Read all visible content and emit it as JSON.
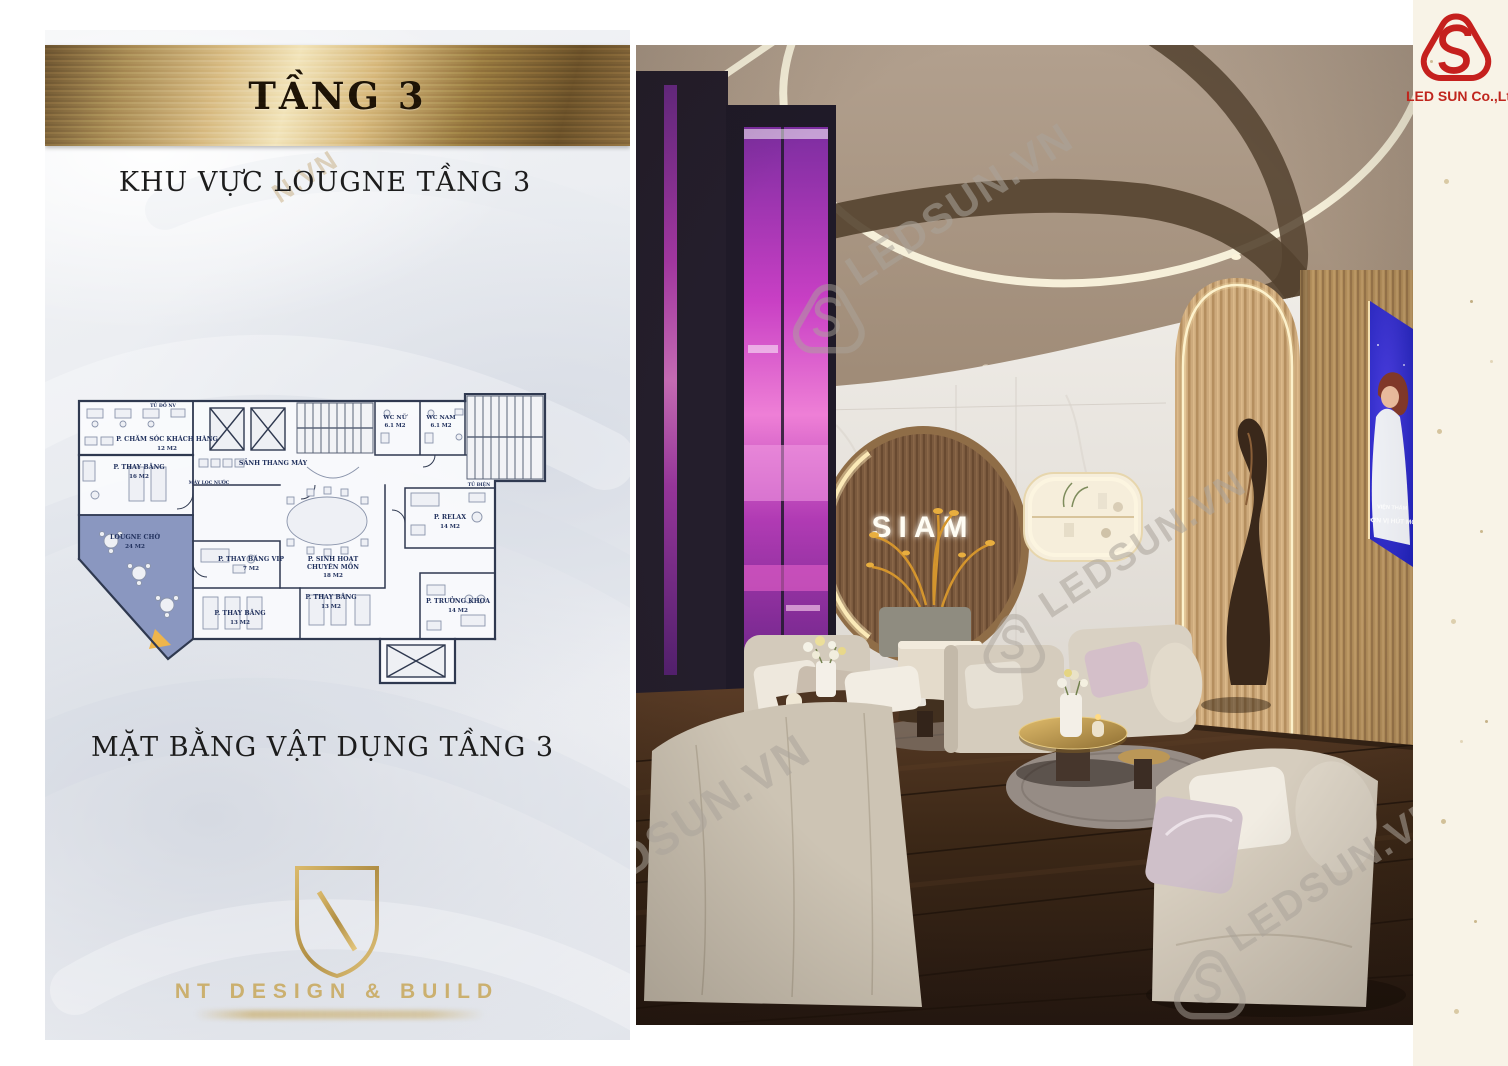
{
  "page": {
    "background": "#ffffff",
    "side_strip_color": "#f8f3e7"
  },
  "brand": {
    "name": "LED SUN Co.,Ltd",
    "registered_mark": "®",
    "color": "#c5201e"
  },
  "left_panel": {
    "banner_title": "TẦNG 3",
    "subtitle": "KHU VỰC LOUGNE TẦNG 3",
    "caption": "MẶT BẰNG VẬT DỤNG TẦNG 3",
    "gold_color": "#b9995c",
    "watermark_fragment": "N.VN",
    "nt_logo": {
      "monogram": "NT",
      "name": "NT DESIGN & BUILD"
    },
    "floor_plan": {
      "highlight_color": "#5b6fa8",
      "rooms": [
        {
          "lines": [
            "P. CHĂM SÓC KHÁCH HÀNG"
          ],
          "area": "12 M2"
        },
        {
          "lines": [
            "P. THAY BĂNG"
          ],
          "area": "16 M2"
        },
        {
          "lines": [
            "SẢNH THANG MÁY"
          ],
          "area": ""
        },
        {
          "lines": [
            "LOUGNE CHỜ"
          ],
          "area": "24 M2"
        },
        {
          "lines": [
            "P. THAY BĂNG VIP"
          ],
          "area": "7 M2"
        },
        {
          "lines": [
            "P. SINH HOẠT",
            "CHUYÊN MÔN"
          ],
          "area": "18 M2"
        },
        {
          "lines": [
            "P. THAY BĂNG"
          ],
          "area": "13 M2"
        },
        {
          "lines": [
            "P. THAY BĂNG"
          ],
          "area": "13 M2"
        },
        {
          "lines": [
            "WC NỮ"
          ],
          "area": "6.1 M2"
        },
        {
          "lines": [
            "WC NAM"
          ],
          "area": "6.1 M2"
        },
        {
          "lines": [
            "P. RELAX"
          ],
          "area": "14 M2"
        },
        {
          "lines": [
            "P. TRƯỞNG KHOA"
          ],
          "area": "14 M2"
        }
      ],
      "small_labels": [
        "TỦ ĐỒ NV",
        "MÁY LỌC NƯỚC",
        "TỦ ĐIỆN"
      ]
    }
  },
  "photo": {
    "sign_text": "SIAM",
    "screen": {
      "line1": "VIỆN THẨM",
      "line2": "ĐƠN VỊ HÚT MỠ"
    },
    "watermark_text": "LEDSUN.VN"
  }
}
